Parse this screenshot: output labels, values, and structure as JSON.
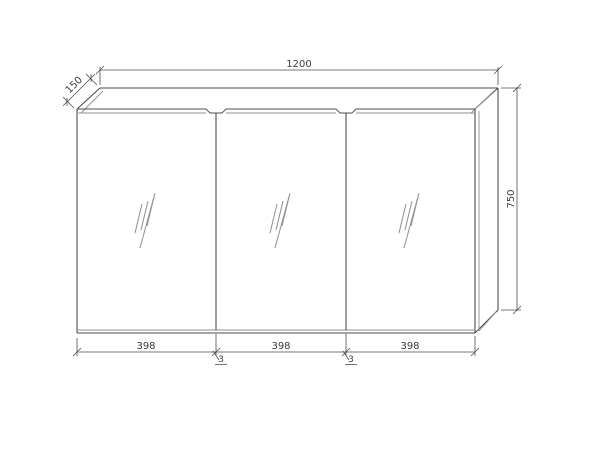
{
  "drawing": {
    "name": "three-door-mirror-cabinet-technical-drawing",
    "colors": {
      "background": "#ffffff",
      "line_main": "#4d4d4d",
      "line_light": "#8f8f8f",
      "text": "#3c3c3c"
    },
    "dimensions": {
      "overall_width": "1200",
      "depth": "150",
      "height": "750",
      "door_widths": [
        "398",
        "398",
        "398"
      ],
      "gap_labels": [
        "3",
        "3"
      ]
    }
  }
}
